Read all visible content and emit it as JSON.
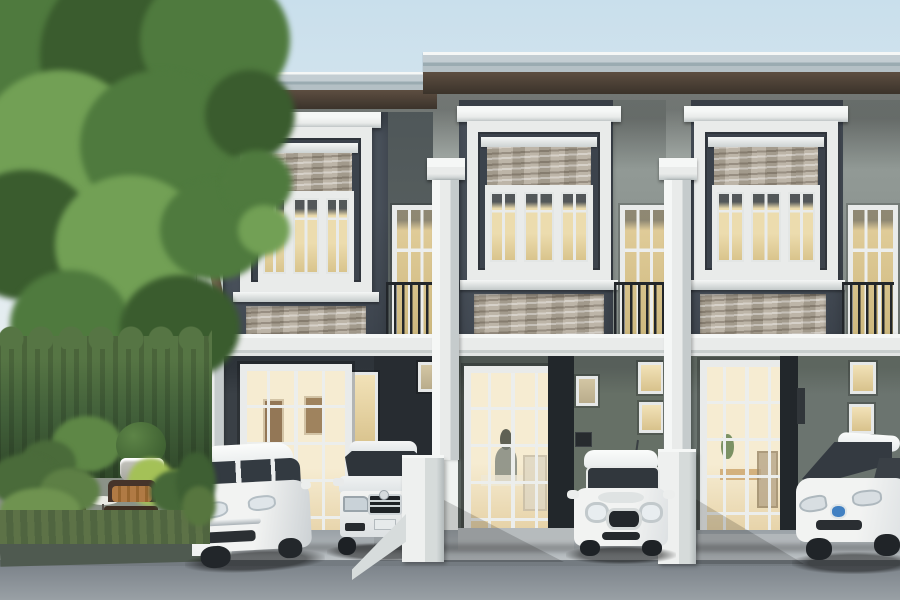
{
  "meta": {
    "title": "Townhouse exterior 3D rendering",
    "description": "Daytime 3D architectural rendering of a row of three modern-classic two-storey townhouses in dark grey with white trim, stone window accents and juliet balconies; four cars parked in the driveways; tall tree, trimmed hedge and garden seating on the left; concrete driveway and street in the foreground.",
    "canvas": {
      "width": 900,
      "height": 600
    },
    "visible_text": []
  },
  "palette": {
    "sky_top": "#c9dfec",
    "sky_mid": "#dfeaf0",
    "sky_bot": "#f0f3f1",
    "fascia": "#c3cdd2",
    "fascia_dark": "#9aabb1",
    "soffit": "#3b332b",
    "soffit_hi": "#5d4e41",
    "wall_dark": "#4a525c",
    "wall_dark2": "#3c434c",
    "wall_light": "#a3aaa6",
    "wall_light2": "#878f8b",
    "trim": "#e9ebea",
    "trim_hi": "#f5f7f6",
    "trim_sh": "#c5cbcc",
    "stone": "#b4ab9c",
    "glass_warm": "#ecdcae",
    "glass_warm2": "#d9c48c",
    "railing": "#22262a",
    "ground_u1": "#3a4046",
    "ground_recess": "#272c31",
    "ground_u2": "#5b635f",
    "ground_u2b": "#667066",
    "ground_u3": "#6b746f",
    "reveal": "#22272b",
    "door_glow": "#f6ecd2",
    "door_glow2": "#e4cfa2",
    "drive": "#c3c8cb",
    "drive_dark": "#9aa1a6",
    "street_top": "#7d848b",
    "street_bot": "#99a0a5",
    "curb": "#4f5a50",
    "patio": "#8b9288",
    "hedge": "#42603a",
    "hedge_hi": "#567544",
    "tree_dark": "#3a5c2e",
    "tree_mid": "#4f7a3e",
    "tree_light": "#72a055",
    "trunk": "#8a7260",
    "trunk_dark": "#5f4d3e",
    "leaf_accent": "#a4c157",
    "car_white": "#f2f3f2",
    "car_shade": "#ccd1d4",
    "car_glass": "#333a41",
    "badge_blue": "#4180c2",
    "wicker": "#46342a",
    "cushion_red": "#6e3b2d",
    "cushion_tan": "#b07a44",
    "urn": "#c6c6bf"
  },
  "scene": {
    "type": "3d-architectural-rendering",
    "time_of_day": "day",
    "building": {
      "storeys": 2,
      "units": [
        {
          "id": "unit-1",
          "roof": "flat, slightly lower than neighbours",
          "upper": "large white-framed window with stone infill and pediment",
          "balcony": "narrow juliet-balcony window",
          "ground": "white french door with lit interior, carport"
        },
        {
          "id": "unit-2",
          "upper": "large white-framed window with stone infill and pediment",
          "balcony": "narrow juliet-balcony window",
          "ground": "recessed french door with lit interior, carport with small windows"
        },
        {
          "id": "unit-3",
          "upper": "large white-framed window with stone infill and pediment",
          "balcony": "narrow juliet-balcony window",
          "ground": "french door with lit dining room, carport with small lit windows"
        }
      ],
      "shared_features": [
        "white pilasters between units",
        "white inter-storey band",
        "stacked-stone veneer accents",
        "dark brown eaves soffit",
        "black iron balcony railings"
      ]
    },
    "vehicles": [
      {
        "id": "car-1",
        "style": "compact hatchback",
        "color": "white",
        "location": "unit-1 driveway, angled"
      },
      {
        "id": "car-2",
        "style": "luxury sedan",
        "color": "silver-white",
        "location": "unit-1/2 carport, front view"
      },
      {
        "id": "car-3",
        "style": "mini hatchback",
        "color": "white",
        "location": "unit-2 carport, front view"
      },
      {
        "id": "car-4",
        "style": "aerodynamic hybrid hatchback",
        "color": "white",
        "badge_color": "#4180c2",
        "location": "unit-3 carport, partly cropped at right edge"
      }
    ],
    "landscape": [
      "tall leafy tree on the left",
      "trimmed tall hedge",
      "two wicker garden armchairs with cushions",
      "small round white side table",
      "stone urn planter with round topiary",
      "tropical foliage and low shrubs",
      "light concrete driveways",
      "grey asphalt street in foreground"
    ]
  }
}
